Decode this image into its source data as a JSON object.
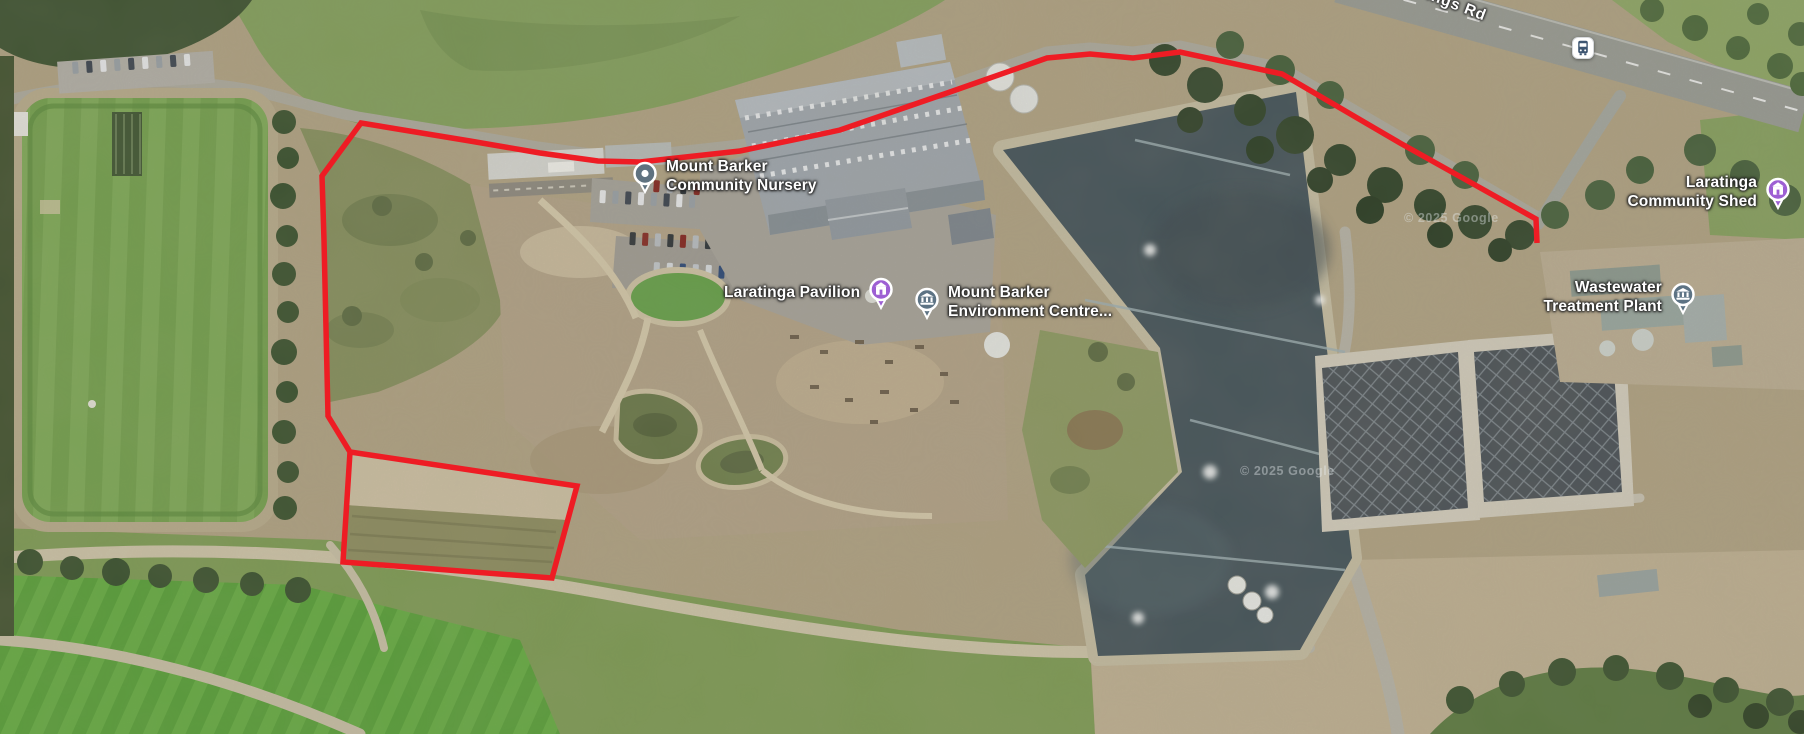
{
  "map": {
    "road_label": "Springs Rd",
    "attribution": "© 2025 Google",
    "attribution2": "© 2025 Google",
    "pois": {
      "nursery": {
        "label": "Mount Barker\nCommunity Nursery",
        "pin": "place-dot"
      },
      "pavilion": {
        "label": "Laratinga Pavilion",
        "pin": "purple-building"
      },
      "environment_centre": {
        "label": "Mount Barker\nEnvironment Centre...",
        "pin": "museum"
      },
      "community_shed": {
        "label": "Laratinga\nCommunity Shed",
        "pin": "purple-building"
      },
      "treatment_plant": {
        "label": "Wastewater\nTreatment Plant",
        "pin": "museum"
      }
    },
    "icons": {
      "bus_stop": "bus-stop-icon"
    },
    "colors": {
      "annotation_red": "#ee1c24",
      "poi_purple": "#9d5fd3",
      "poi_slate": "#5d7384",
      "pond_water": "#44535a"
    }
  }
}
